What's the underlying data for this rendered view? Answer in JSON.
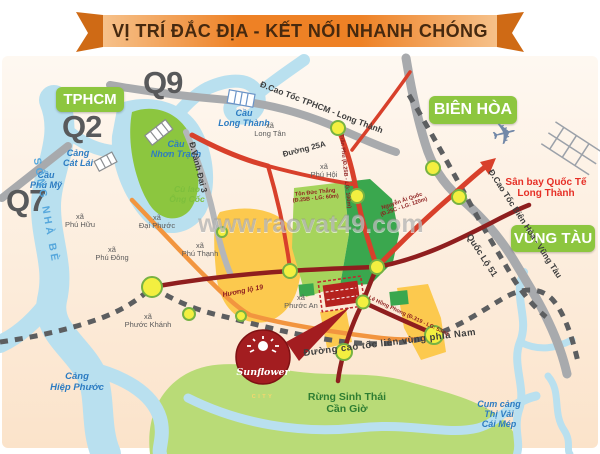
{
  "banner": {
    "title": "VỊ TRÍ ĐẮC ĐỊA - KẾT NỐI NHANH CHÓNG"
  },
  "watermark": "www.raovat49.com",
  "regions": {
    "tphcm": "TPHCM",
    "bien_hoa": "BIÊN HÒA",
    "vung_tau": "VŨNG TÀU"
  },
  "districts": {
    "q9": "Q9",
    "q2": "Q2",
    "q7": "Q7"
  },
  "waterways": {
    "song_nha_be": "SÔNG NHÀ BÈ",
    "cu_lao_ong_coc": "Cù lao\nÔng Cốc"
  },
  "bridges_ports": {
    "cau_phu_my": "Cầu\nPhú Mỹ",
    "cang_cat_lai": "Cảng\nCát Lái",
    "cau_nhon_trach": "Cầu\nNhơn Trạch",
    "cau_long_thanh": "Cầu\nLong Thành",
    "cang_hiep_phuoc": "Cảng\nHiệp Phước",
    "cum_cang_thi_vai": "Cụm cảng\nThị Vải\nCái Mép"
  },
  "communes": {
    "phu_huu": "xã\nPhú Hữu",
    "phu_dong": "xã\nPhú Đông",
    "dai_phuoc": "xã\nĐại Phước",
    "phu_thanh": "xã\nPhú Thạnh",
    "phuoc_khanh": "xã\nPhước Khánh",
    "phuoc_an": "xã\nPhước An",
    "long_tan": "xã\nLong Tân",
    "phu_hoi": "xã\nPhú Hội"
  },
  "roads": {
    "cao_toc_tphcm_long_thanh": "Đ.Cao Tốc TPHCM - Long Thành",
    "duong_25a": "Đường 25A",
    "vanh_dai_3": "Đ.Vành Đai 3",
    "quoc_lo_51": "Quốc Lộ 51",
    "cao_toc_bien_hoa_vung_tau": "Đ.Cao Tốc Biên Hòa - Vũng Tàu",
    "cao_toc_lien_vung": "Đường cao tốc liên vùng phía Nam",
    "huong_lo_19": "Hương lộ 19",
    "tran_phu": "Trần Phú (Đ.25B - LG: 100m)",
    "ton_duc_thang": "Tôn Đức Thắng\n(Đ.25B - LG: 60m)",
    "nguyen_ai_quoc": "Nguyễn Ái Quốc\n(Đ.25C - LG: 120m)",
    "le_hong_phong": "Lê Hồng Phong (Đ.319 - LG: 53m)"
  },
  "landmarks": {
    "airport": "Sân bay Quốc Tế\nLong Thành",
    "airplane_icon": "✈",
    "forest": "Rừng Sinh Thái\nCần Giờ"
  },
  "logo": {
    "brand": "Sunflower",
    "suffix": "CITY"
  },
  "colors": {
    "ribbon_orange": "#ee8125",
    "region_green": "#8dc63f",
    "water_blue": "#b9e0ef",
    "road_gray": "#a8aaad",
    "road_red": "#d8402b",
    "road_maroon": "#8f1e1e",
    "road_orange": "#f2953f",
    "zone_yellow": "#fcc94e",
    "zone_green": "#3aa74e",
    "node_yellow": "#f3ef40",
    "brand_red": "#a31d20"
  }
}
